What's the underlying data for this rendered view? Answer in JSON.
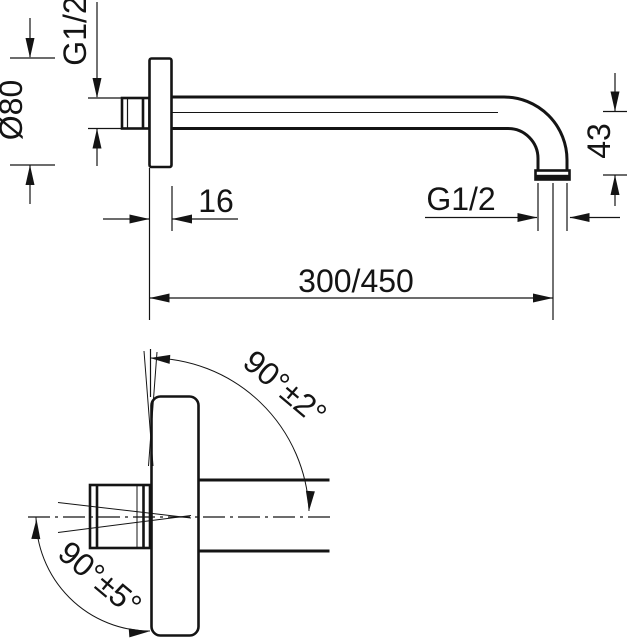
{
  "drawing": {
    "kind": "technical dimension drawing",
    "subject": "wall-mounted shower arm, front view and side view",
    "colors": {
      "line": "#141414",
      "background": "#ffffff"
    }
  },
  "front_view": {
    "inlet_thread_label": "G1/2",
    "flange_diameter_label": "Ø80",
    "flange_thickness_label": "16",
    "outlet_thread_label": "G1/2",
    "arm_length_label": "300/450",
    "outlet_drop_label": "43"
  },
  "side_view": {
    "outlet_angle_label": "90°±2°",
    "inlet_angle_label": "90°±5°"
  }
}
